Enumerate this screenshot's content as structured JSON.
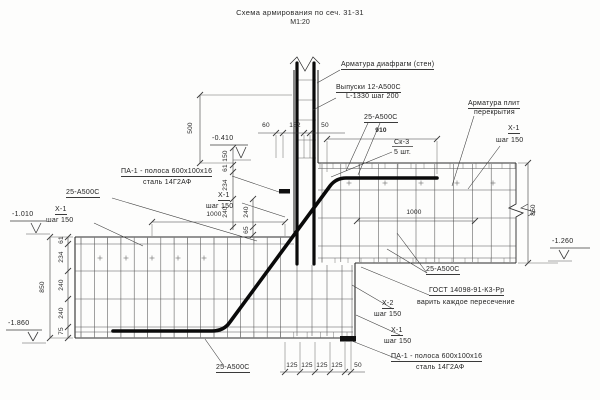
{
  "title": {
    "line1": "Схема армирования по сеч. 31-31",
    "line2": "М1:20"
  },
  "callouts": {
    "arm_diafragm": "Арматура диафрагм (стен)",
    "vypuski_1": "Выпуски 12-А500С",
    "vypuski_2": "L-1330 шаг 200",
    "a500_top": "25-А500С",
    "sk3_num": "Ск-3",
    "sk3_qty": "5 шт.",
    "arm_plit_1": "Арматура плит",
    "arm_plit_2": "перекрытия",
    "x1_top_right_1": "Х-1",
    "x1_top_right_2": "шаг 150",
    "pa1_left_1": "ПА-1 - полоса 600х100х16",
    "pa1_left_2": "сталь 14Г2АФ",
    "a500_left": "25-А500С",
    "x1_left_1": "Х-1",
    "x1_left_2": "шаг 150",
    "x1_mid_1": "Х-1",
    "x1_mid_2": "шаг 150",
    "a500_right": "25-А500С",
    "gost_1": "ГОСТ 14098-91-К3-Рр",
    "gost_2": "варить каждое пересечение",
    "x2_right_1": "Х-2",
    "x2_right_2": "шаг 150",
    "x1_bot_right_1": "Х-1",
    "x1_bot_right_2": "шаг 150",
    "pa1_right_1": "ПА-1 - полоса 600х100х16",
    "pa1_right_2": "сталь 14Г2АФ",
    "a500_bot": "25-А500С"
  },
  "dimensions": {
    "d60": "60",
    "d182": "182",
    "d50": "50",
    "d910": "910",
    "d500": "500",
    "d1000_left": "1000",
    "d1000_right": "1000",
    "d850_left": "850",
    "d850_right": "850",
    "chain_left": [
      "61",
      "234",
      "240",
      "240",
      "75"
    ],
    "chain_wall_a": [
      "150",
      "61",
      "234",
      "240"
    ],
    "chain_wall_b": [
      "240",
      "65"
    ],
    "d125_seq": [
      "125",
      "125",
      "125",
      "125"
    ],
    "d50_bot": "50"
  },
  "elevations": {
    "minus_0410": "-0.410",
    "minus_1010": "-1.010",
    "minus_1860": "-1.860",
    "minus_1260": "-1.260"
  },
  "colors": {
    "line": "#3c3c3c",
    "edge": "#2b2b2b",
    "rebar": "#0a0a0a",
    "text": "#232323",
    "paper": "#fdfdfc"
  }
}
